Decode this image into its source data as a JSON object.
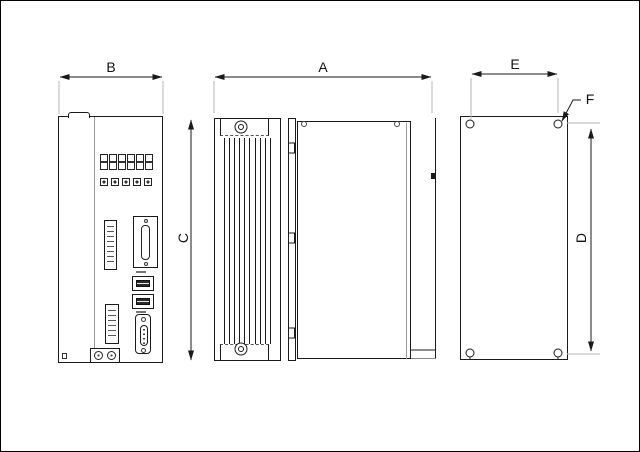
{
  "canvas": {
    "width": 640,
    "height": 452,
    "background": "#ffffff",
    "border_color": "#000000"
  },
  "colors": {
    "line": "#1a1a1a",
    "faint_extension_line": "#b5b5b5",
    "fill": "#ffffff"
  },
  "dimension_labels": {
    "a": "A",
    "b": "B",
    "c": "C",
    "d": "D",
    "e": "E",
    "f": "F"
  },
  "views": {
    "front": {
      "display_digits": "888888",
      "button_count": 5
    },
    "side": {
      "heatsink_fin_groups": 2
    },
    "rear": {
      "mounting_hole_count": 4
    }
  }
}
